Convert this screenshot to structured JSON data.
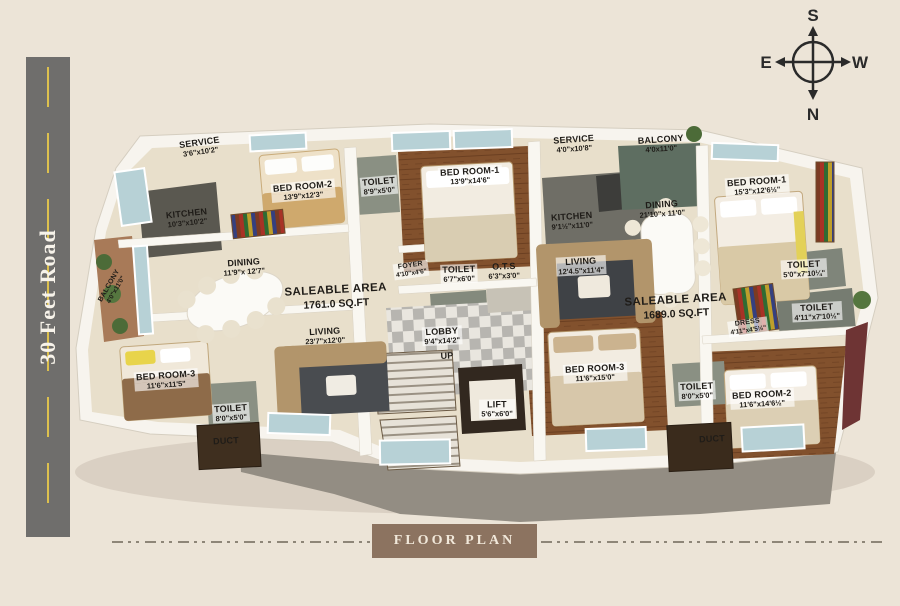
{
  "page": {
    "background_color": "#ece4d7",
    "width": 900,
    "height": 606
  },
  "road": {
    "label": "30 Feet Road",
    "surface_color": "#6f6e6c",
    "center_line_color": "#dcc04e"
  },
  "compass": {
    "top": "S",
    "bottom": "N",
    "left": "E",
    "right": "W"
  },
  "footer": {
    "label": "FLOOR PLAN",
    "box_color": "#8c7360"
  },
  "palette": {
    "cream_background": "#ece4d7",
    "road_gray": "#6f6e6c",
    "road_line_yellow": "#dcc04e",
    "floor_beige": "#e8dfcb",
    "wood_brown": "#82512d",
    "footer_brown": "#8c7360",
    "label_text": "#1f1c18"
  },
  "plan": {
    "saleable_areas": [
      "1761.0 SQ.FT",
      "1689.0 SQ.FT"
    ],
    "rooms": [
      {
        "id": "service-left",
        "name": "SERVICE",
        "dims": "3'6\"x10'2\"",
        "x": 200,
        "y": 147,
        "rot": -8
      },
      {
        "id": "bedroom2-left",
        "name": "BED ROOM-2",
        "dims": "13'9\"x12'3\"",
        "x": 303,
        "y": 191,
        "rot": -5,
        "cls": "plate"
      },
      {
        "id": "toilet-a",
        "name": "TOILET",
        "dims": "8'9\"x5'0\"",
        "x": 379,
        "y": 186,
        "rot": -5,
        "cls": "plate"
      },
      {
        "id": "kitchen-left",
        "name": "KITCHEN",
        "dims": "10'3\"x10'2\"",
        "x": 187,
        "y": 218,
        "rot": -6
      },
      {
        "id": "dining-left",
        "name": "DINING",
        "dims": "11'9\"x 12'7\"",
        "x": 244,
        "y": 267,
        "rot": -4
      },
      {
        "id": "saleable-left",
        "name": "SALEABLE AREA",
        "dims": "1761.0 SQ.FT",
        "x": 336,
        "y": 297,
        "rot": -3,
        "cls": "saleable"
      },
      {
        "id": "balcony-left",
        "name": "BALCONY",
        "dims": "4'0\"x11'0\"",
        "x": 113,
        "y": 288,
        "rot": -60,
        "cls": "tiny"
      },
      {
        "id": "living-left",
        "name": "LIVING",
        "dims": "23'7\"x12'0\"",
        "x": 325,
        "y": 336,
        "rot": -3
      },
      {
        "id": "bedroom3-left",
        "name": "BED ROOM-3",
        "dims": "11'6\"x11'5\"",
        "x": 166,
        "y": 380,
        "rot": -4,
        "cls": "plate"
      },
      {
        "id": "toilet-b",
        "name": "TOILET",
        "dims": "8'0\"x5'0\"",
        "x": 231,
        "y": 413,
        "rot": -4,
        "cls": "plate"
      },
      {
        "id": "duct-left",
        "name": "DUCT",
        "dims": "",
        "x": 226,
        "y": 441,
        "rot": -3
      },
      {
        "id": "bedroom1-mid",
        "name": "BED ROOM-1",
        "dims": "13'9\"x14'6\"",
        "x": 470,
        "y": 176,
        "rot": -3,
        "cls": "plate"
      },
      {
        "id": "foyer",
        "name": "FOYER",
        "dims": "4'10\"x4'6\"",
        "x": 411,
        "y": 270,
        "rot": -8,
        "cls": "tiny plate"
      },
      {
        "id": "toilet-c",
        "name": "TOILET",
        "dims": "6'7\"x6'0\"",
        "x": 459,
        "y": 274,
        "rot": -2,
        "cls": "plate"
      },
      {
        "id": "ots",
        "name": "O.T.S",
        "dims": "6'3\"x3'0\"",
        "x": 504,
        "y": 271,
        "rot": -2
      },
      {
        "id": "service-mid",
        "name": "SERVICE",
        "dims": "4'0\"x10'8\"",
        "x": 574,
        "y": 144,
        "rot": -4
      },
      {
        "id": "kitchen-mid",
        "name": "KITCHEN",
        "dims": "9'1½\"x11'0\"",
        "x": 572,
        "y": 221,
        "rot": -4
      },
      {
        "id": "living-right",
        "name": "LIVING",
        "dims": "12'4.5\"x11'4\"",
        "x": 581,
        "y": 266,
        "rot": -3,
        "cls": "plate"
      },
      {
        "id": "lobby",
        "name": "LOBBY",
        "dims": "9'4\"x14'2\"",
        "x": 442,
        "y": 336,
        "rot": -3,
        "cls": "plate"
      },
      {
        "id": "up",
        "name": "UP",
        "dims": "",
        "x": 447,
        "y": 356,
        "rot": -3
      },
      {
        "id": "lift",
        "name": "LIFT",
        "dims": "5'6\"x6'0\"",
        "x": 497,
        "y": 409,
        "rot": -1,
        "cls": "plate"
      },
      {
        "id": "bedroom3-mid",
        "name": "BED ROOM-3",
        "dims": "11'6\"x15'0\"",
        "x": 595,
        "y": 373,
        "rot": -3,
        "cls": "plate"
      },
      {
        "id": "balcony-right",
        "name": "BALCONY",
        "dims": "4'0x11'0\"",
        "x": 661,
        "y": 144,
        "rot": -4
      },
      {
        "id": "dining-right",
        "name": "DINING",
        "dims": "21'10\"x 11'0\"",
        "x": 662,
        "y": 209,
        "rot": -4
      },
      {
        "id": "bedroom1-right",
        "name": "BED ROOM-1",
        "dims": "15'3\"x12'6½\"",
        "x": 757,
        "y": 186,
        "rot": -4,
        "cls": "plate"
      },
      {
        "id": "toilet-d",
        "name": "TOILET",
        "dims": "5'0\"x7'10¼\"",
        "x": 804,
        "y": 269,
        "rot": -3,
        "cls": "plate"
      },
      {
        "id": "toilet-e",
        "name": "TOILET",
        "dims": "4'11\"x7'10½\"",
        "x": 817,
        "y": 312,
        "rot": -3,
        "cls": "plate"
      },
      {
        "id": "dress",
        "name": "DRESS",
        "dims": "4'11\"x4'5½\"",
        "x": 748,
        "y": 327,
        "rot": -8,
        "cls": "tiny plate"
      },
      {
        "id": "saleable-right",
        "name": "SALEABLE AREA",
        "dims": "1689.0 SQ.FT",
        "x": 676,
        "y": 307,
        "rot": -3,
        "cls": "saleable"
      },
      {
        "id": "toilet-f",
        "name": "TOILET",
        "dims": "8'0\"x5'0\"",
        "x": 697,
        "y": 391,
        "rot": -3,
        "cls": "plate"
      },
      {
        "id": "bedroom2-right",
        "name": "BED ROOM-2",
        "dims": "11'6\"x14'6½\"",
        "x": 762,
        "y": 399,
        "rot": -3,
        "cls": "plate"
      },
      {
        "id": "duct-right",
        "name": "DUCT",
        "dims": "",
        "x": 712,
        "y": 439,
        "rot": -3
      }
    ]
  }
}
